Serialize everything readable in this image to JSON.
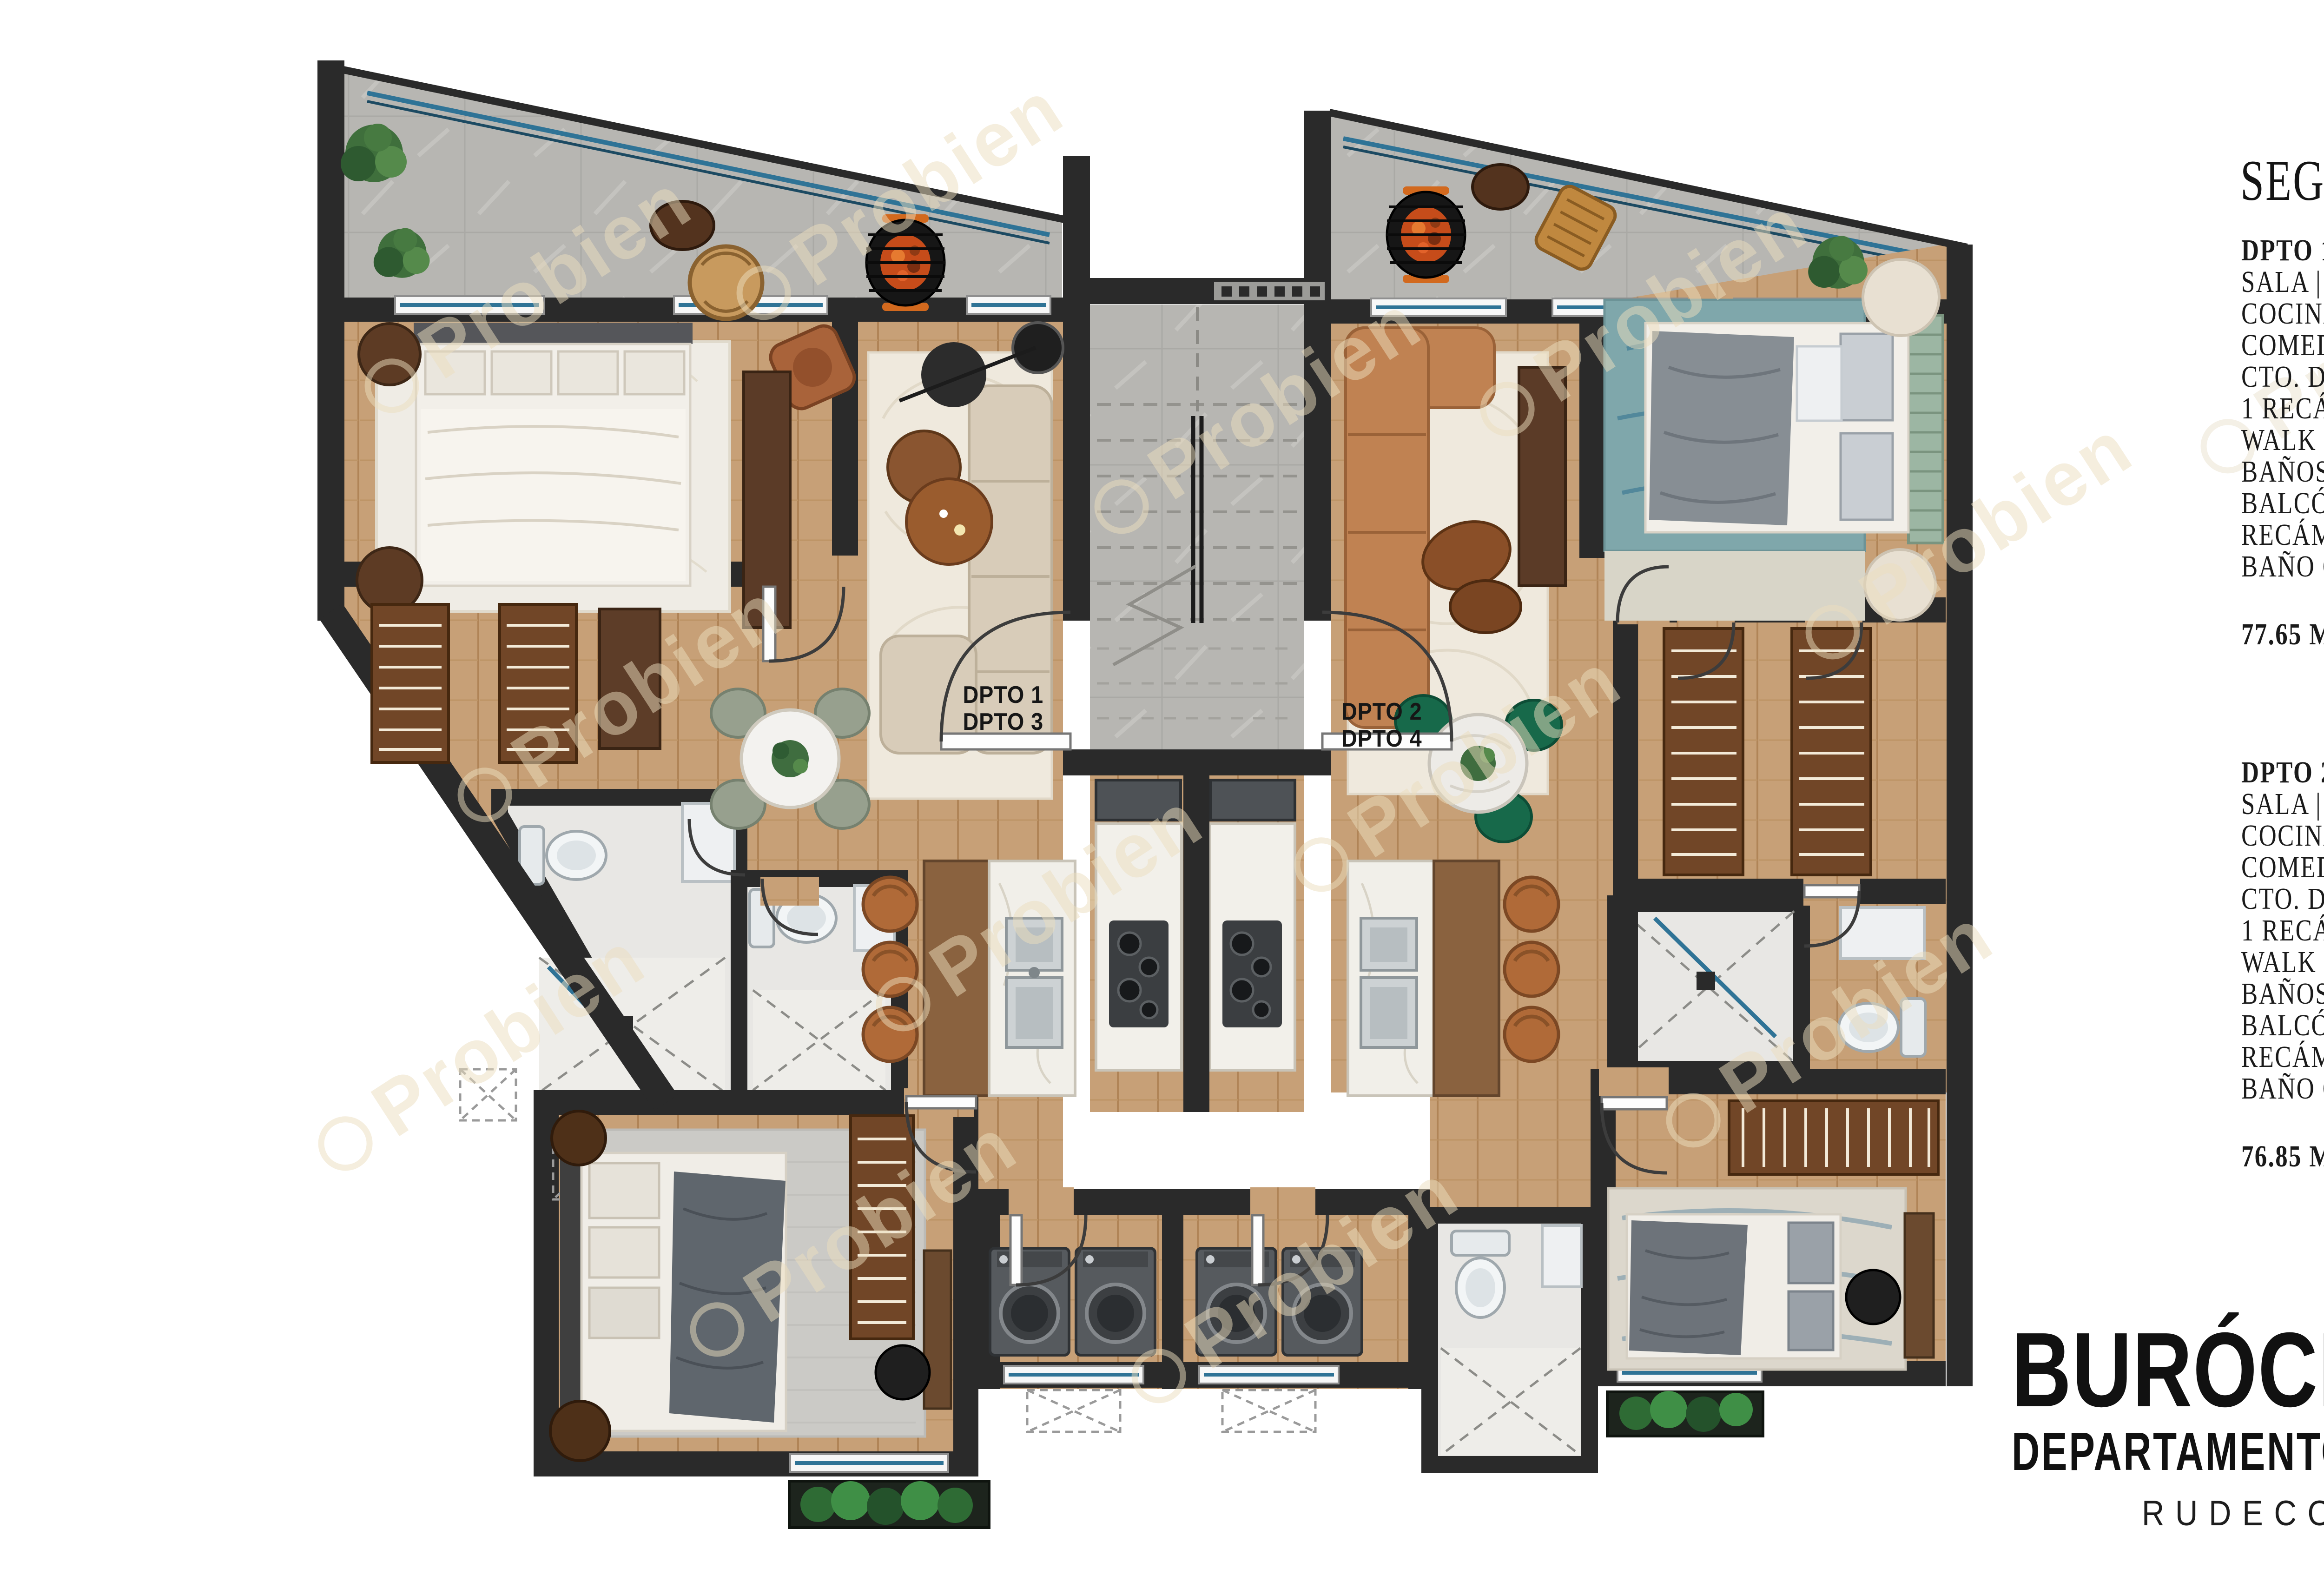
{
  "panel": {
    "title": "SEGUNDO Y TERCER NIVEL",
    "apartments": [
      {
        "header": "DPTO 1 Y 3",
        "features": [
          "SALA | BALCÓN",
          "COCINA | BARRA",
          "COMEDOR",
          "CTO. DE SERVICIO",
          "1 RECÁMARA PRINCIPAL",
          "WALK IN CLOSET",
          "BAÑOS PRINCIPAL",
          "BALCÓN",
          "RECÁMARA SECUNDARIA",
          "BAÑO COMPLETO"
        ],
        "area": "77.65 METROS CUADRADOS"
      },
      {
        "header": "DPTO 2 Y 4",
        "features": [
          "SALA | BALCÓN",
          "COCINA | BARRA",
          "COMEDOR",
          "CTO. DE SERVICIO",
          "1 RECÁMARA PRINCIPAL",
          "WALK IN CLOSET",
          "BAÑOS PRINCIPAL",
          "BALCÓN",
          "RECÁMARA SECUNDARIA",
          "BAÑO COMPLETO"
        ],
        "area": "76.85 METROS CUADRADOS"
      }
    ]
  },
  "brand": {
    "name": "BURÓCRATAS II",
    "subtitle": "DEPARTAMENTOS",
    "builder": "RUDECO CONSTRUCTORA"
  },
  "plan": {
    "watermark": "Probien",
    "unit_label_left": {
      "line1": "DPTO 1",
      "line2": "DPTO 3"
    },
    "unit_label_right": {
      "line1": "DPTO 2",
      "line2": "DPTO 4"
    },
    "colors": {
      "wall": "#2a2a2a",
      "wood": "#c7a077",
      "stone": "#b6b5b1",
      "glass": "#2f7396",
      "accent_green": "#17694a"
    }
  }
}
